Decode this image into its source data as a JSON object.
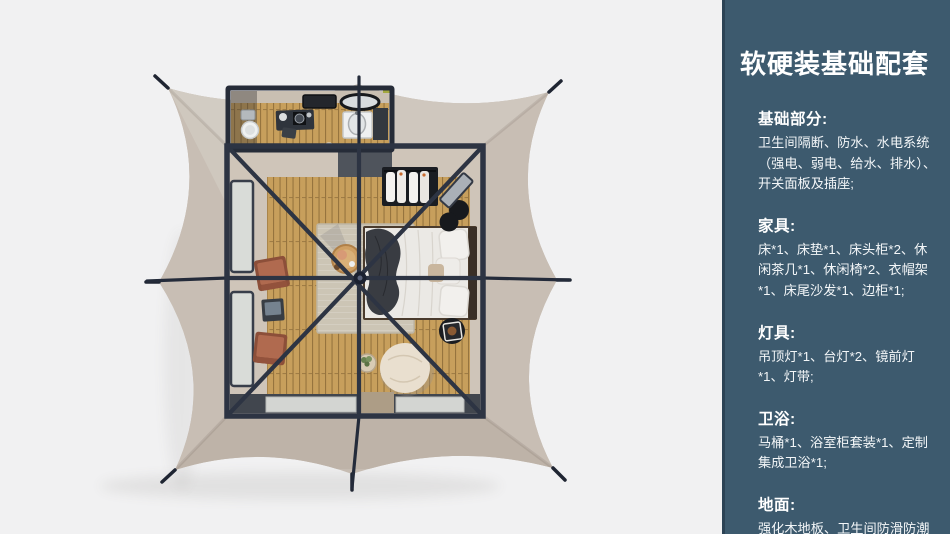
{
  "panel": {
    "title": "软硬装基础配套",
    "sections": [
      {
        "heading": "基础部分:",
        "body": "卫生间隔断、防水、水电系统（强电、弱电、给水、排水）、开关面板及插座;"
      },
      {
        "heading": "家具:",
        "body": "床*1、床垫*1、床头柜*2、休闲茶几*1、休闲椅*2、衣帽架*1、床尾沙发*1、边柜*1;"
      },
      {
        "heading": "灯具:",
        "body": "吊顶灯*1、台灯*2、镜前灯*1、灯带;"
      },
      {
        "heading": "卫浴:",
        "body": "马桶*1、浴室柜套装*1、定制集成卫浴*1;"
      },
      {
        "heading": "地面:",
        "body": "强化木地板、卫生间防滑防潮石塑板;"
      }
    ]
  },
  "colors": {
    "sidebar-bg": "#3d5a6e",
    "sidebar-edge": "#2c4355",
    "panel-text": "#f3f6f8",
    "scene-bg": "#f1f1f2",
    "canopy": "#c6bcb2",
    "canopy-light": "#cfc7be",
    "canopy-mid": "#c8beb4",
    "canopy-dark": "#beb3a8",
    "frame": "#2d3443",
    "room-bg": "#cfc5b9",
    "wood": "#c79f5c",
    "wood-line": "#96743e",
    "rug": "#ccc5b5",
    "bed-white": "#ebe9e5",
    "throw": "#393c42",
    "terracotta": "#b06a4f",
    "pouf": "#e9dfcf",
    "dark-item": "#17191d",
    "window": "#d9dcd8"
  }
}
